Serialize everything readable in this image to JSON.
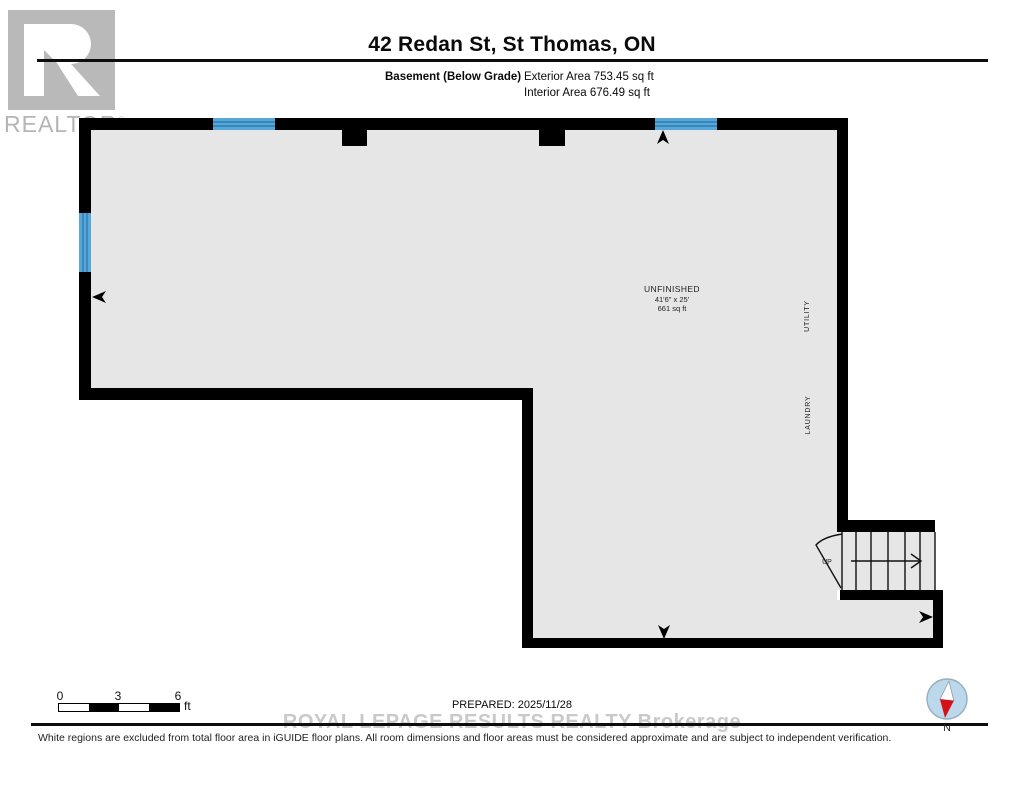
{
  "header": {
    "title": "42 Redan St, St Thomas, ON",
    "floor_label": "Basement (Below Grade)",
    "exterior_area": "Exterior Area 753.45 sq ft",
    "interior_area": "Interior Area 676.49 sq ft"
  },
  "logo": {
    "brand": "REALTOR",
    "registered": "®"
  },
  "plan": {
    "room": {
      "name": "UNFINISHED",
      "dimensions": "41'6\" x 25'",
      "area": "661 sq ft"
    },
    "labels": {
      "utility": "UTILITY",
      "laundry": "LAUNDRY"
    },
    "stairs": {
      "up_label": "UP"
    }
  },
  "scale_bar": {
    "ticks": [
      "0",
      "3",
      "6"
    ],
    "unit": "ft"
  },
  "footer": {
    "prepared": "PREPARED: 2025/11/28",
    "watermark": "ROYAL LEPAGE RESULTS REALTY Brokerage",
    "disclaimer": "White regions are excluded from total floor area in iGUIDE floor plans. All room dimensions and floor areas must be considered approximate and are subject to independent verification.",
    "compass_north": "N"
  },
  "colors": {
    "wall": "#000000",
    "floor_fill": "#e6e6e6",
    "window_blue": "#58a8d7",
    "window_line": "#2d7cb0",
    "watermark_gray": "#c9c9c9",
    "logo_gray": "#b9b9b9",
    "compass_fill": "#bcd9ec",
    "compass_red": "#d41216"
  }
}
